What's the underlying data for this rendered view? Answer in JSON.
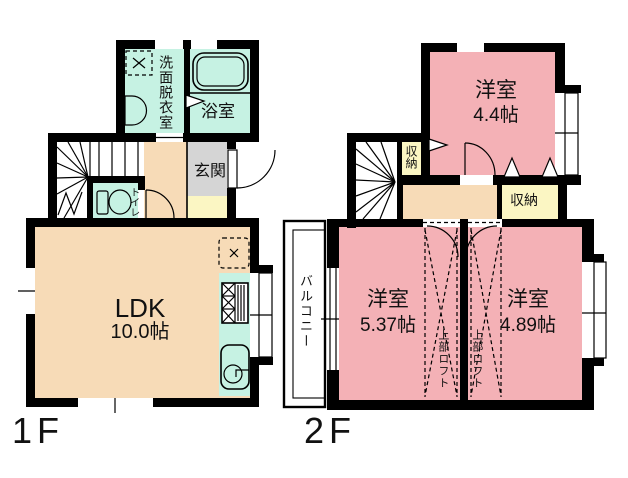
{
  "floors": {
    "f1": {
      "label": "1F",
      "rooms": {
        "ldk": {
          "name": "LDK",
          "size": "10.0帖"
        },
        "washroom": {
          "name": "洗面脱衣室"
        },
        "bathroom": {
          "name": "浴室"
        },
        "toilet": {
          "name": "トイレ"
        },
        "entrance": {
          "name": "玄関"
        }
      }
    },
    "f2": {
      "label": "2F",
      "rooms": {
        "bedroom_a": {
          "name": "洋室",
          "size": "4.4帖"
        },
        "bedroom_b": {
          "name": "洋室",
          "size": "5.37帖"
        },
        "bedroom_c": {
          "name": "洋室",
          "size": "4.89帖"
        },
        "closet_upper": {
          "name": "収納"
        },
        "closet_lower": {
          "name": "収納"
        },
        "balcony": {
          "name": "バルコニー"
        },
        "loft_b": {
          "name": "上部ロフト"
        },
        "loft_c": {
          "name": "上部ロフト"
        }
      }
    }
  },
  "colors": {
    "bg": "#FFFFFF",
    "wall": "#000000",
    "room_pink": "#F4B1B6",
    "floor_peach": "#F7DBB7",
    "wet_cyan": "#C6F2E3",
    "closet_yellow": "#FBF6C3",
    "entry_gray": "#D5D5D5"
  }
}
